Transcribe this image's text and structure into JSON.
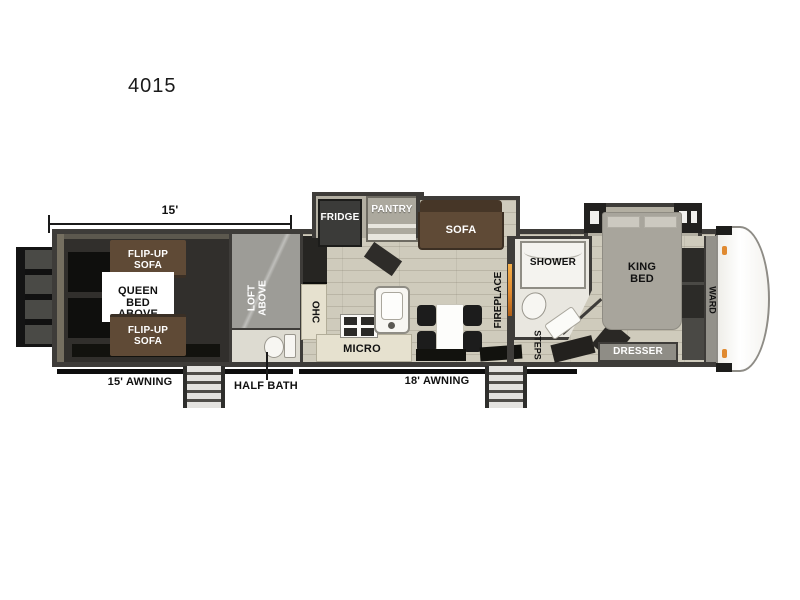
{
  "title": "4015",
  "floorplan": {
    "dim_garage": "15'",
    "garage": {
      "flip_up_sofa_top": "FLIP-UP SOFA",
      "queen_bed_above": "QUEEN BED ABOVE",
      "flip_up_sofa_bottom": "FLIP-UP SOFA"
    },
    "loft": {
      "loft_above": "LOFT ABOVE",
      "half_bath": "HALF BATH"
    },
    "kitchen": {
      "ohc": "OHC",
      "micro": "MICRO",
      "fridge": "FRIDGE",
      "pantry": "PANTRY"
    },
    "living": {
      "sofa": "SOFA",
      "fireplace": "FIREPLACE"
    },
    "bath": {
      "shower": "SHOWER",
      "steps": "STEPS"
    },
    "bedroom": {
      "king_bed": "KING BED",
      "ward": "WARD",
      "dresser": "DRESSER"
    },
    "exterior": {
      "awning_rear": "15' AWNING",
      "awning_main": "18' AWNING"
    }
  },
  "colors": {
    "outline": "#3e3c39",
    "floor": "#cfcbbc",
    "garage_floor": "#312f2c",
    "loft_gray": "#9d9c97",
    "sofa_brown": "#5f4a36",
    "sofa_brown_dark": "#463627",
    "fireplace_orange": "#e08a30",
    "bed_gray": "#a8a59c",
    "cabinet_cream": "#e6e1cf",
    "fixture_white": "#f7f6f2",
    "mat_black": "#12120e"
  }
}
